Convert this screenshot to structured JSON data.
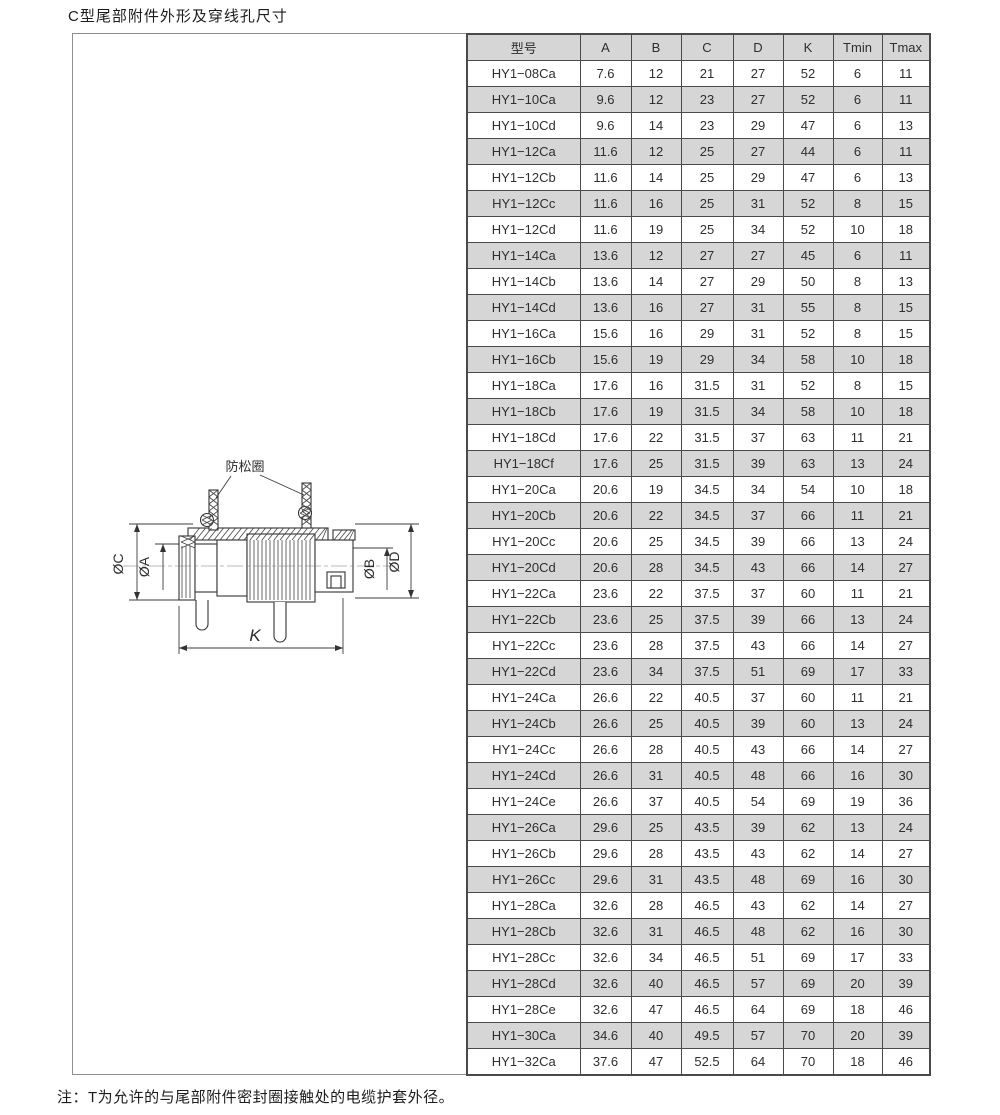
{
  "page": {
    "title": "C型尾部附件外形及穿线孔尺寸",
    "note": "注：T为允许的与尾部附件密封圈接触处的电缆护套外径。"
  },
  "drawing": {
    "part_label": "防松圈",
    "dim_c": "ØC",
    "dim_a": "ØA",
    "dim_b": "ØB",
    "dim_d": "ØD",
    "dim_k": "K"
  },
  "table": {
    "headers": [
      "型号",
      "A",
      "B",
      "C",
      "D",
      "K",
      "Tmin",
      "Tmax"
    ],
    "rows": [
      [
        "HY1−08Ca",
        "7.6",
        "12",
        "21",
        "27",
        "52",
        "6",
        "11"
      ],
      [
        "HY1−10Ca",
        "9.6",
        "12",
        "23",
        "27",
        "52",
        "6",
        "11"
      ],
      [
        "HY1−10Cd",
        "9.6",
        "14",
        "23",
        "29",
        "47",
        "6",
        "13"
      ],
      [
        "HY1−12Ca",
        "11.6",
        "12",
        "25",
        "27",
        "44",
        "6",
        "11"
      ],
      [
        "HY1−12Cb",
        "11.6",
        "14",
        "25",
        "29",
        "47",
        "6",
        "13"
      ],
      [
        "HY1−12Cc",
        "11.6",
        "16",
        "25",
        "31",
        "52",
        "8",
        "15"
      ],
      [
        "HY1−12Cd",
        "11.6",
        "19",
        "25",
        "34",
        "52",
        "10",
        "18"
      ],
      [
        "HY1−14Ca",
        "13.6",
        "12",
        "27",
        "27",
        "45",
        "6",
        "11"
      ],
      [
        "HY1−14Cb",
        "13.6",
        "14",
        "27",
        "29",
        "50",
        "8",
        "13"
      ],
      [
        "HY1−14Cd",
        "13.6",
        "16",
        "27",
        "31",
        "55",
        "8",
        "15"
      ],
      [
        "HY1−16Ca",
        "15.6",
        "16",
        "29",
        "31",
        "52",
        "8",
        "15"
      ],
      [
        "HY1−16Cb",
        "15.6",
        "19",
        "29",
        "34",
        "58",
        "10",
        "18"
      ],
      [
        "HY1−18Ca",
        "17.6",
        "16",
        "31.5",
        "31",
        "52",
        "8",
        "15"
      ],
      [
        "HY1−18Cb",
        "17.6",
        "19",
        "31.5",
        "34",
        "58",
        "10",
        "18"
      ],
      [
        "HY1−18Cd",
        "17.6",
        "22",
        "31.5",
        "37",
        "63",
        "11",
        "21"
      ],
      [
        "HY1−18Cf",
        "17.6",
        "25",
        "31.5",
        "39",
        "63",
        "13",
        "24"
      ],
      [
        "HY1−20Ca",
        "20.6",
        "19",
        "34.5",
        "34",
        "54",
        "10",
        "18"
      ],
      [
        "HY1−20Cb",
        "20.6",
        "22",
        "34.5",
        "37",
        "66",
        "11",
        "21"
      ],
      [
        "HY1−20Cc",
        "20.6",
        "25",
        "34.5",
        "39",
        "66",
        "13",
        "24"
      ],
      [
        "HY1−20Cd",
        "20.6",
        "28",
        "34.5",
        "43",
        "66",
        "14",
        "27"
      ],
      [
        "HY1−22Ca",
        "23.6",
        "22",
        "37.5",
        "37",
        "60",
        "11",
        "21"
      ],
      [
        "HY1−22Cb",
        "23.6",
        "25",
        "37.5",
        "39",
        "66",
        "13",
        "24"
      ],
      [
        "HY1−22Cc",
        "23.6",
        "28",
        "37.5",
        "43",
        "66",
        "14",
        "27"
      ],
      [
        "HY1−22Cd",
        "23.6",
        "34",
        "37.5",
        "51",
        "69",
        "17",
        "33"
      ],
      [
        "HY1−24Ca",
        "26.6",
        "22",
        "40.5",
        "37",
        "60",
        "11",
        "21"
      ],
      [
        "HY1−24Cb",
        "26.6",
        "25",
        "40.5",
        "39",
        "60",
        "13",
        "24"
      ],
      [
        "HY1−24Cc",
        "26.6",
        "28",
        "40.5",
        "43",
        "66",
        "14",
        "27"
      ],
      [
        "HY1−24Cd",
        "26.6",
        "31",
        "40.5",
        "48",
        "66",
        "16",
        "30"
      ],
      [
        "HY1−24Ce",
        "26.6",
        "37",
        "40.5",
        "54",
        "69",
        "19",
        "36"
      ],
      [
        "HY1−26Ca",
        "29.6",
        "25",
        "43.5",
        "39",
        "62",
        "13",
        "24"
      ],
      [
        "HY1−26Cb",
        "29.6",
        "28",
        "43.5",
        "43",
        "62",
        "14",
        "27"
      ],
      [
        "HY1−26Cc",
        "29.6",
        "31",
        "43.5",
        "48",
        "69",
        "16",
        "30"
      ],
      [
        "HY1−28Ca",
        "32.6",
        "28",
        "46.5",
        "43",
        "62",
        "14",
        "27"
      ],
      [
        "HY1−28Cb",
        "32.6",
        "31",
        "46.5",
        "48",
        "62",
        "16",
        "30"
      ],
      [
        "HY1−28Cc",
        "32.6",
        "34",
        "46.5",
        "51",
        "69",
        "17",
        "33"
      ],
      [
        "HY1−28Cd",
        "32.6",
        "40",
        "46.5",
        "57",
        "69",
        "20",
        "39"
      ],
      [
        "HY1−28Ce",
        "32.6",
        "47",
        "46.5",
        "64",
        "69",
        "18",
        "46"
      ],
      [
        "HY1−30Ca",
        "34.6",
        "40",
        "49.5",
        "57",
        "70",
        "20",
        "39"
      ],
      [
        "HY1−32Ca",
        "37.6",
        "47",
        "52.5",
        "64",
        "70",
        "18",
        "46"
      ]
    ]
  },
  "colors": {
    "row_shade": "#d6d6d6",
    "grid_line": "#4a4a4a",
    "frame_line": "#8e8e8e",
    "text": "#2e2e2e"
  }
}
